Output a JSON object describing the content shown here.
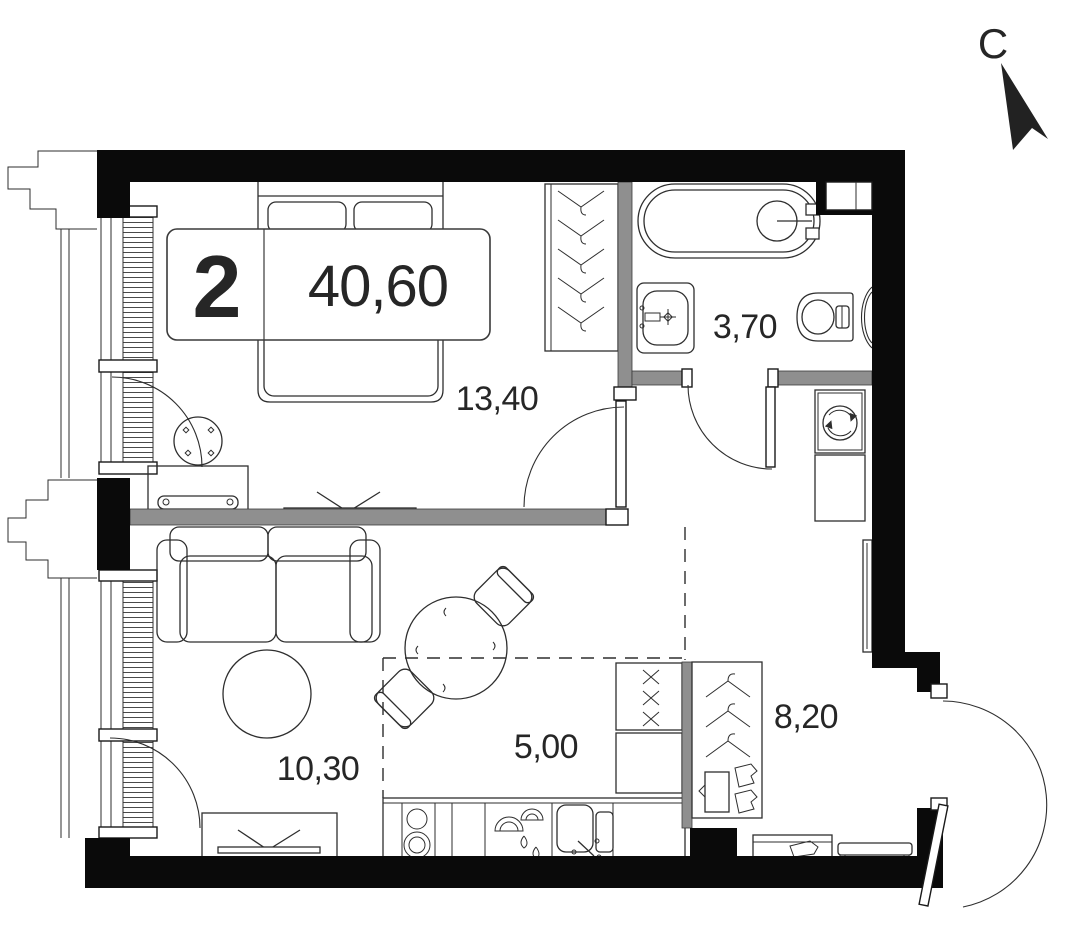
{
  "compass": {
    "north_letter": "С"
  },
  "unit_badge": {
    "room_count": "2",
    "total_area": "40,60"
  },
  "room_labels": {
    "bedroom": "13,40",
    "bathroom": "3,70",
    "living_room": "10,30",
    "kitchen": "5,00",
    "hallway": "8,20"
  },
  "colors": {
    "wall": "#0a0a0a",
    "partition": "#8f8f8f",
    "furniture_line": "#2e2e2e",
    "text": "#262626",
    "background": "#ffffff"
  }
}
